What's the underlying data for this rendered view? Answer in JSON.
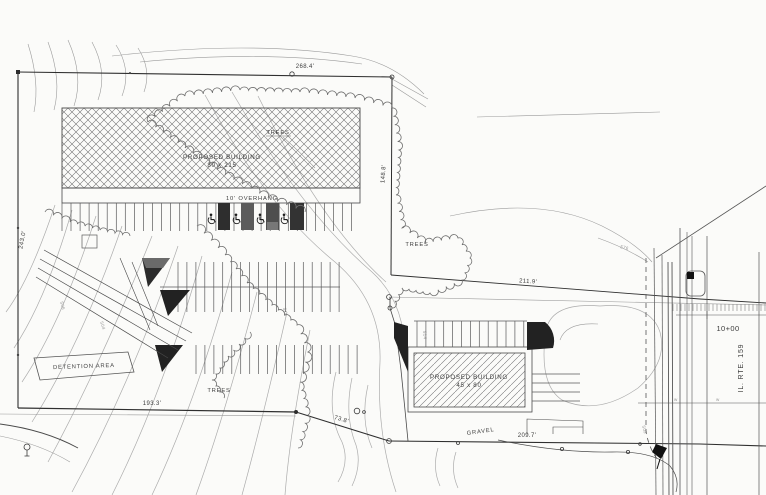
{
  "plan": {
    "buildings": [
      {
        "name": "PROPOSED BUILDING",
        "size": "80 x 215"
      },
      {
        "name": "PROPOSED BUILDING",
        "size": "45 x 80"
      }
    ],
    "overhang": "10' OVERHANG",
    "trees": "TREES",
    "detention": "DETENTION AREA",
    "gravel": "GRAVEL",
    "road": {
      "name": "IL. RTE. 159",
      "station": "10+00"
    },
    "dims": {
      "north": "268.4'",
      "west": "243.0'",
      "east": "148.8'",
      "northeast": "211.9'",
      "southwest": "193.3'",
      "connector": "73.8'",
      "south": "209.7'"
    },
    "contour_labels": [
      "506",
      "504",
      "510",
      "514",
      "502",
      "576"
    ],
    "water_marker": "w"
  },
  "colors": {
    "paper": "#fbfbf9",
    "linework": "#2f2f2f",
    "contour": "#acacac",
    "fill_dark": "#1d1d1d"
  }
}
